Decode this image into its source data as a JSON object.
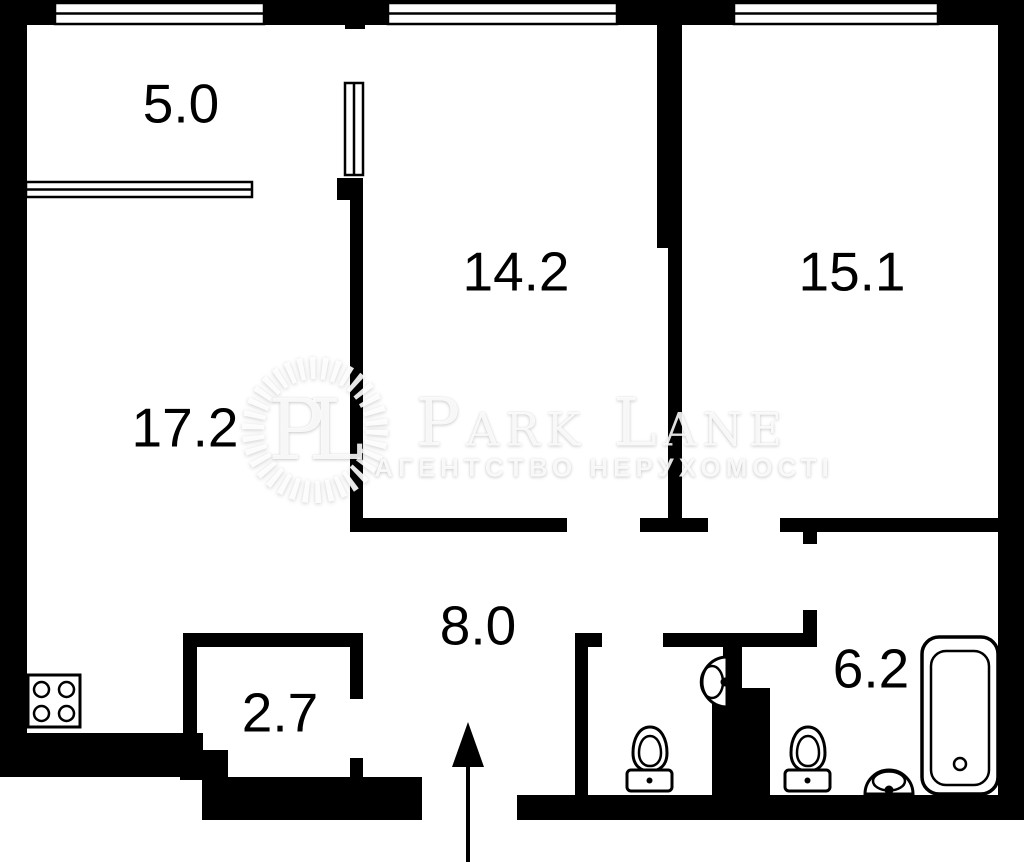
{
  "floorplan": {
    "rooms": [
      {
        "name": "balcony",
        "area_sqm": "5.0"
      },
      {
        "name": "room-middle",
        "area_sqm": "14.2"
      },
      {
        "name": "room-right",
        "area_sqm": "15.1"
      },
      {
        "name": "living-room",
        "area_sqm": "17.2"
      },
      {
        "name": "hallway",
        "area_sqm": "8.0"
      },
      {
        "name": "closet",
        "area_sqm": "2.7"
      },
      {
        "name": "bathroom",
        "area_sqm": "6.2"
      }
    ],
    "fixtures": [
      "stove",
      "toilet",
      "wash-basin",
      "toilet",
      "wash-basin",
      "bathtub",
      "entrance-arrow"
    ],
    "watermark": {
      "monogram": "PL",
      "brand": "Park Lane",
      "tagline": "АГЕНТСТВО НЕРУХОМОСТІ"
    },
    "colors": {
      "walls": "#000000",
      "background": "#ffffff"
    }
  }
}
